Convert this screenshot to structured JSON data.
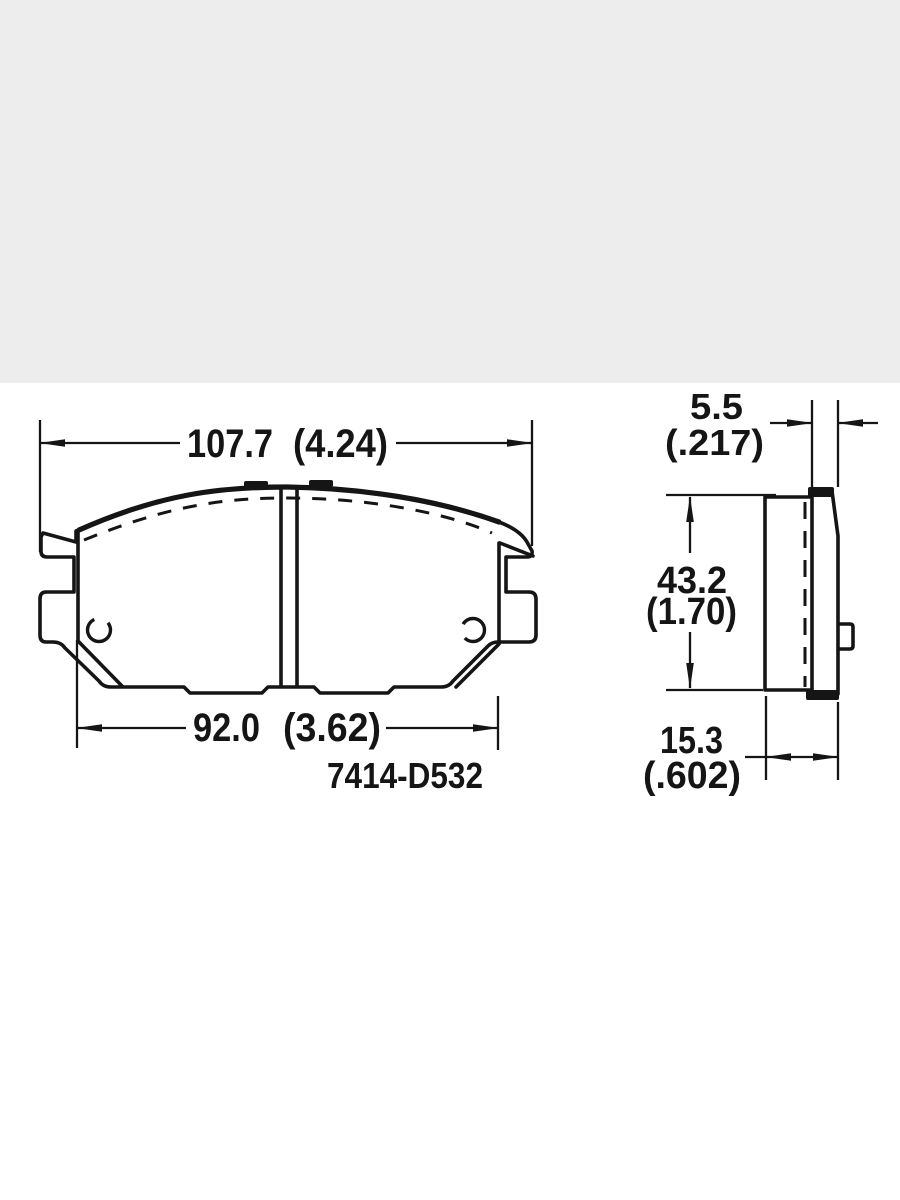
{
  "page": {
    "top_band_color": "#ededed",
    "canvas_color": "#ffffff"
  },
  "drawing": {
    "part_number": "7414-D532",
    "line_color": "#151515",
    "front_view": {
      "overall_width_mm": "107.7",
      "overall_width_in": "(4.24)",
      "pad_width_mm": "92.0",
      "pad_width_in": "(3.62)"
    },
    "side_view": {
      "plate_thickness_mm": "5.5",
      "plate_thickness_in": "(.217)",
      "height_mm": "43.2",
      "height_in": "(1.70)",
      "total_depth_mm": "15.3",
      "total_depth_in": "(.602)"
    }
  }
}
